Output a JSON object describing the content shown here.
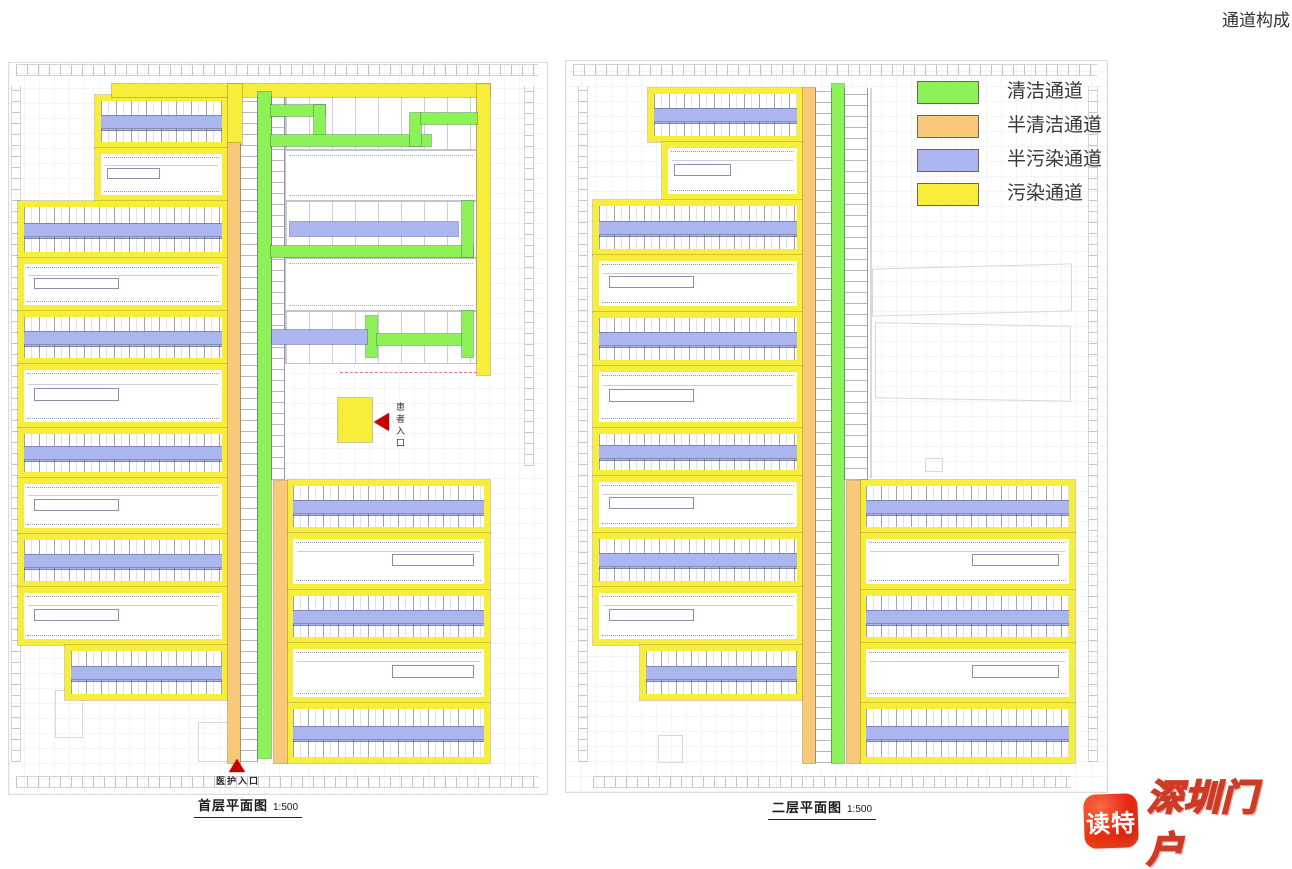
{
  "title": "通道构成",
  "legend": {
    "items": [
      {
        "key": "clean",
        "label": "清洁通道",
        "color": "#8df258"
      },
      {
        "key": "semi_clean",
        "label": "半清洁通道",
        "color": "#f9c97a"
      },
      {
        "key": "semi_polluted",
        "label": "半污染通道",
        "color": "#abb5ef"
      },
      {
        "key": "polluted",
        "label": "污染通道",
        "color": "#f6ee3a"
      }
    ]
  },
  "plans": [
    {
      "id": "floor1",
      "label": "首层平面图",
      "scale": "1:500",
      "entrances": [
        {
          "label": "患者入口"
        },
        {
          "label": "医护入口"
        }
      ]
    },
    {
      "id": "floor2",
      "label": "二层平面图",
      "scale": "1:500",
      "entrances": []
    }
  ],
  "watermark": {
    "app": "读特",
    "portal": "深圳门户"
  }
}
